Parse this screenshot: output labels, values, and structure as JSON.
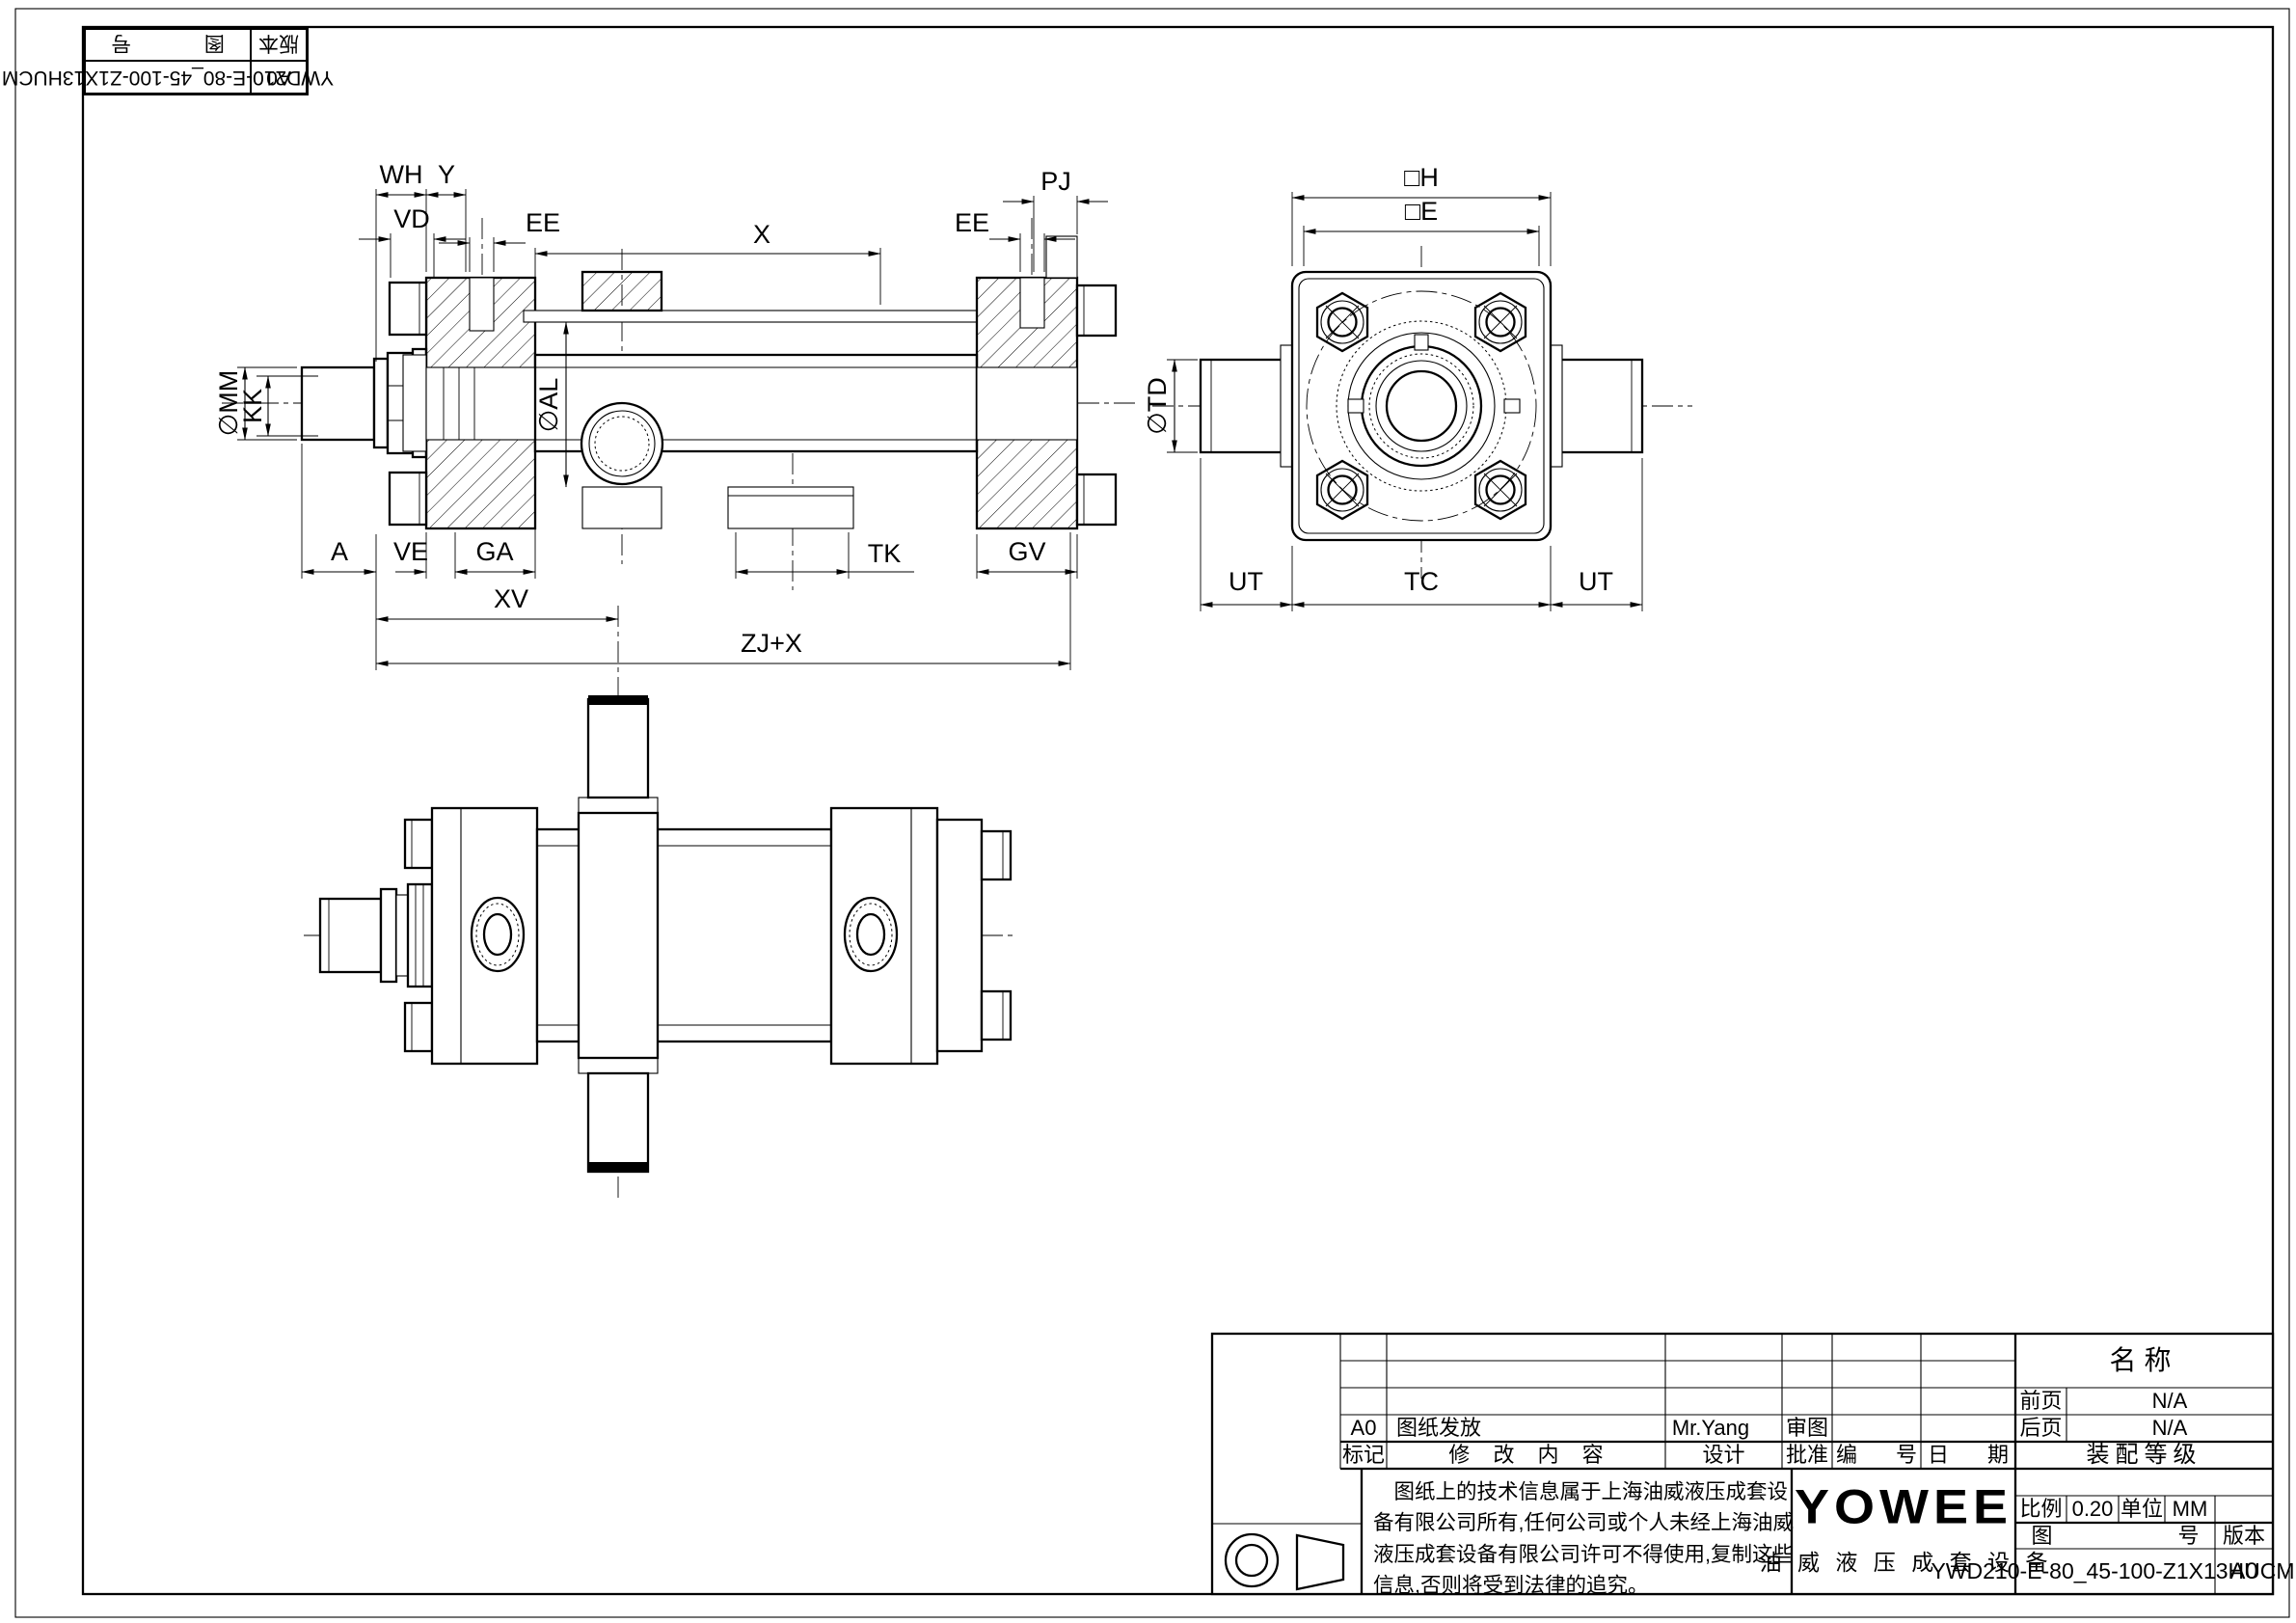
{
  "corner_stamp": {
    "drawing_no_label": "图 号",
    "version_label": "版本",
    "drawing_no": "YWD210-E-80_45-100-Z1X13HUCM",
    "version": "A0"
  },
  "dims": {
    "main": {
      "wh": "WH",
      "y": "Y",
      "vd": "VD",
      "ee_front": "EE",
      "x": "X",
      "ee_rear": "EE",
      "pj": "PJ",
      "mm": "∅MM",
      "kk": "KK",
      "al": "∅AL",
      "a": "A",
      "ve": "VE",
      "ga": "GA",
      "tk": "TK",
      "gv": "GV",
      "xv": "XV",
      "zj_x": "ZJ+X"
    },
    "end_view": {
      "h": "□H",
      "e": "□E",
      "td": "∅TD",
      "ut_left": "UT",
      "tc": "TC",
      "ut_right": "UT"
    }
  },
  "title_block": {
    "rev": {
      "mark": "A0",
      "content": "图纸发放",
      "design_by": "Mr.Yang",
      "review": "审图"
    },
    "header": {
      "mark": "标记",
      "content": "修 改 内 容",
      "design": "设计",
      "approve": "批准",
      "number": "编 号",
      "date": "日 期"
    },
    "name_label": "名称",
    "front_label": "前页",
    "front_value": "N/A",
    "back_label": "后页",
    "back_value": "N/A",
    "assembly_label": "装配等级",
    "disclaimer": "图纸上的技术信息属于上海油威液压成套设备有限公司所有,任何公司或个人未经上海油威液压成套设备有限公司许可不得使用,复制这些信息,否则将受到法律的追究。",
    "logo": "YOWEE",
    "company": "油 威 液 压 成 套 设 备",
    "scale_label": "比例",
    "scale_value": "0.20",
    "unit_label": "单位",
    "unit_value": "MM",
    "drawing_no_label": "图 号",
    "version_label": "版本",
    "drawing_no": "YWD210-E-80_45-100-Z1X13HUCM",
    "version": "A0"
  }
}
